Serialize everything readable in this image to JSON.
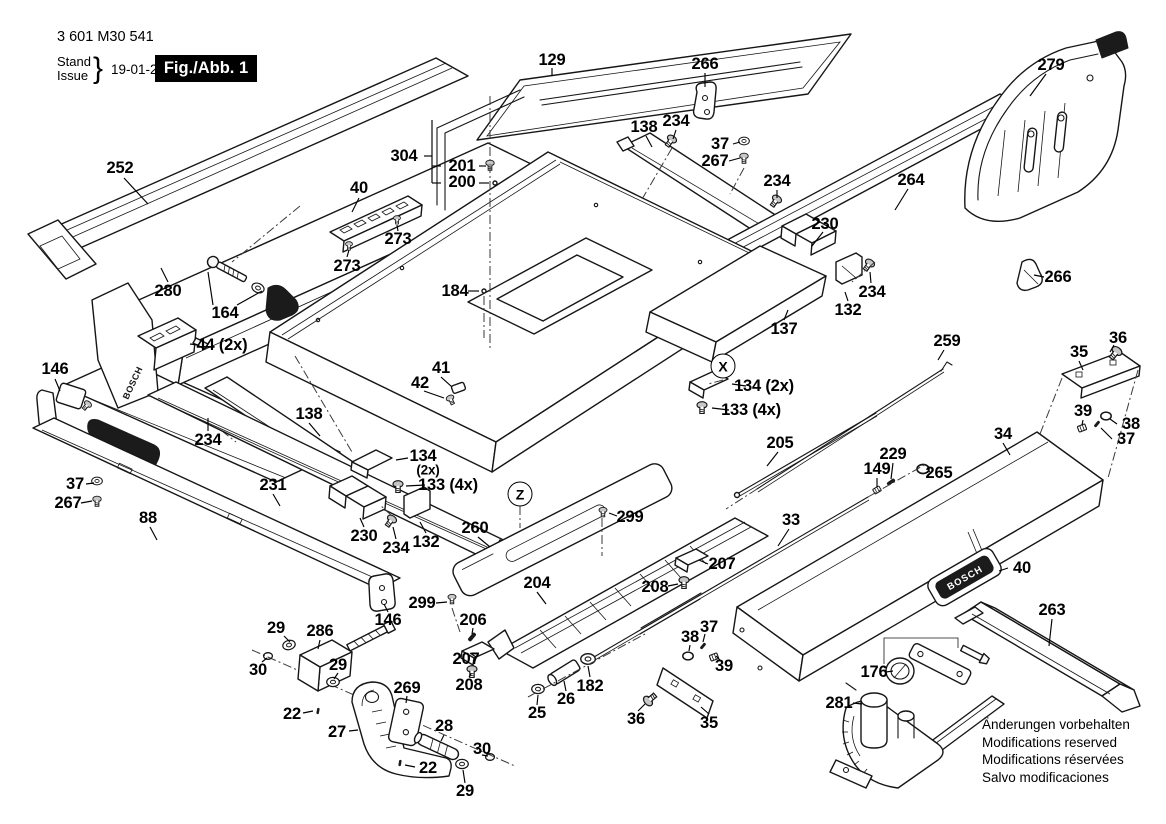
{
  "doc": {
    "part_number": "3 601 M30 541",
    "stand_label": "Stand",
    "issue_label": "Issue",
    "brace": "}",
    "date": "19-01-24",
    "figure_label": "Fig./Abb. 1",
    "brand": "BOSCH",
    "notice_lines": [
      "Änderungen vorbehalten",
      "Modifications reserved",
      "Modifications réservées",
      "Salvo modificaciones"
    ]
  },
  "markers": [
    {
      "text": "X",
      "x": 723,
      "y": 366
    },
    {
      "text": "Z",
      "x": 520,
      "y": 494
    }
  ],
  "labels": [
    {
      "text": "252",
      "x": 120,
      "y": 168
    },
    {
      "text": "280",
      "x": 168,
      "y": 291
    },
    {
      "text": "164",
      "x": 225,
      "y": 313
    },
    {
      "text": "44 (2x)",
      "x": 222,
      "y": 345
    },
    {
      "text": "146",
      "x": 55,
      "y": 369
    },
    {
      "text": "40",
      "x": 359,
      "y": 188
    },
    {
      "text": "273",
      "x": 398,
      "y": 239
    },
    {
      "text": "273",
      "x": 347,
      "y": 266
    },
    {
      "text": "304",
      "x": 404,
      "y": 156
    },
    {
      "text": "201",
      "x": 462,
      "y": 166
    },
    {
      "text": "200",
      "x": 462,
      "y": 182
    },
    {
      "text": "129",
      "x": 552,
      "y": 60
    },
    {
      "text": "266",
      "x": 705,
      "y": 64
    },
    {
      "text": "138",
      "x": 644,
      "y": 127
    },
    {
      "text": "234",
      "x": 676,
      "y": 121
    },
    {
      "text": "37",
      "x": 720,
      "y": 144
    },
    {
      "text": "267",
      "x": 715,
      "y": 161
    },
    {
      "text": "234",
      "x": 777,
      "y": 181
    },
    {
      "text": "264",
      "x": 911,
      "y": 180
    },
    {
      "text": "279",
      "x": 1051,
      "y": 65
    },
    {
      "text": "230",
      "x": 825,
      "y": 224
    },
    {
      "text": "266",
      "x": 1058,
      "y": 277
    },
    {
      "text": "234",
      "x": 872,
      "y": 292
    },
    {
      "text": "132",
      "x": 848,
      "y": 310
    },
    {
      "text": "137",
      "x": 784,
      "y": 329
    },
    {
      "text": "184",
      "x": 455,
      "y": 291
    },
    {
      "text": "259",
      "x": 947,
      "y": 341
    },
    {
      "text": "35",
      "x": 1079,
      "y": 352
    },
    {
      "text": "36",
      "x": 1118,
      "y": 338
    },
    {
      "text": "39",
      "x": 1083,
      "y": 411
    },
    {
      "text": "38",
      "x": 1131,
      "y": 424
    },
    {
      "text": "37",
      "x": 1126,
      "y": 439
    },
    {
      "text": "134 (2x)",
      "x": 764,
      "y": 386
    },
    {
      "text": "133 (4x)",
      "x": 751,
      "y": 410
    },
    {
      "text": "41",
      "x": 441,
      "y": 368
    },
    {
      "text": "42",
      "x": 420,
      "y": 383
    },
    {
      "text": "138",
      "x": 309,
      "y": 414
    },
    {
      "text": "234",
      "x": 208,
      "y": 440
    },
    {
      "text": "134",
      "x": 423,
      "y": 456
    },
    {
      "text": "(2x)",
      "x": 428,
      "y": 470,
      "small": true
    },
    {
      "text": "133 (4x)",
      "x": 448,
      "y": 485
    },
    {
      "text": "231",
      "x": 273,
      "y": 485
    },
    {
      "text": "37",
      "x": 75,
      "y": 484
    },
    {
      "text": "267",
      "x": 68,
      "y": 503
    },
    {
      "text": "88",
      "x": 148,
      "y": 518
    },
    {
      "text": "230",
      "x": 364,
      "y": 536
    },
    {
      "text": "234",
      "x": 396,
      "y": 548
    },
    {
      "text": "132",
      "x": 426,
      "y": 542
    },
    {
      "text": "260",
      "x": 475,
      "y": 528
    },
    {
      "text": "299",
      "x": 630,
      "y": 517
    },
    {
      "text": "205",
      "x": 780,
      "y": 443
    },
    {
      "text": "34",
      "x": 1003,
      "y": 434
    },
    {
      "text": "229",
      "x": 893,
      "y": 454
    },
    {
      "text": "149",
      "x": 877,
      "y": 469
    },
    {
      "text": "265",
      "x": 939,
      "y": 473
    },
    {
      "text": "33",
      "x": 791,
      "y": 520
    },
    {
      "text": "207",
      "x": 722,
      "y": 564
    },
    {
      "text": "208",
      "x": 655,
      "y": 587
    },
    {
      "text": "204",
      "x": 537,
      "y": 583
    },
    {
      "text": "299",
      "x": 422,
      "y": 603
    },
    {
      "text": "146",
      "x": 388,
      "y": 620
    },
    {
      "text": "206",
      "x": 473,
      "y": 620
    },
    {
      "text": "207",
      "x": 466,
      "y": 659
    },
    {
      "text": "208",
      "x": 469,
      "y": 685
    },
    {
      "text": "29",
      "x": 276,
      "y": 628
    },
    {
      "text": "286",
      "x": 320,
      "y": 631
    },
    {
      "text": "30",
      "x": 258,
      "y": 670
    },
    {
      "text": "29",
      "x": 338,
      "y": 665
    },
    {
      "text": "22",
      "x": 292,
      "y": 714
    },
    {
      "text": "27",
      "x": 337,
      "y": 732
    },
    {
      "text": "269",
      "x": 407,
      "y": 688
    },
    {
      "text": "28",
      "x": 444,
      "y": 726
    },
    {
      "text": "30",
      "x": 482,
      "y": 749
    },
    {
      "text": "22",
      "x": 428,
      "y": 768
    },
    {
      "text": "29",
      "x": 465,
      "y": 791
    },
    {
      "text": "25",
      "x": 537,
      "y": 713
    },
    {
      "text": "26",
      "x": 566,
      "y": 699
    },
    {
      "text": "182",
      "x": 590,
      "y": 686
    },
    {
      "text": "36",
      "x": 636,
      "y": 719
    },
    {
      "text": "35",
      "x": 709,
      "y": 723
    },
    {
      "text": "38",
      "x": 690,
      "y": 637
    },
    {
      "text": "37",
      "x": 709,
      "y": 627
    },
    {
      "text": "39",
      "x": 724,
      "y": 666
    },
    {
      "text": "176",
      "x": 874,
      "y": 672
    },
    {
      "text": "281",
      "x": 839,
      "y": 703
    },
    {
      "text": "263",
      "x": 1052,
      "y": 610
    },
    {
      "text": "40",
      "x": 1022,
      "y": 568
    }
  ]
}
